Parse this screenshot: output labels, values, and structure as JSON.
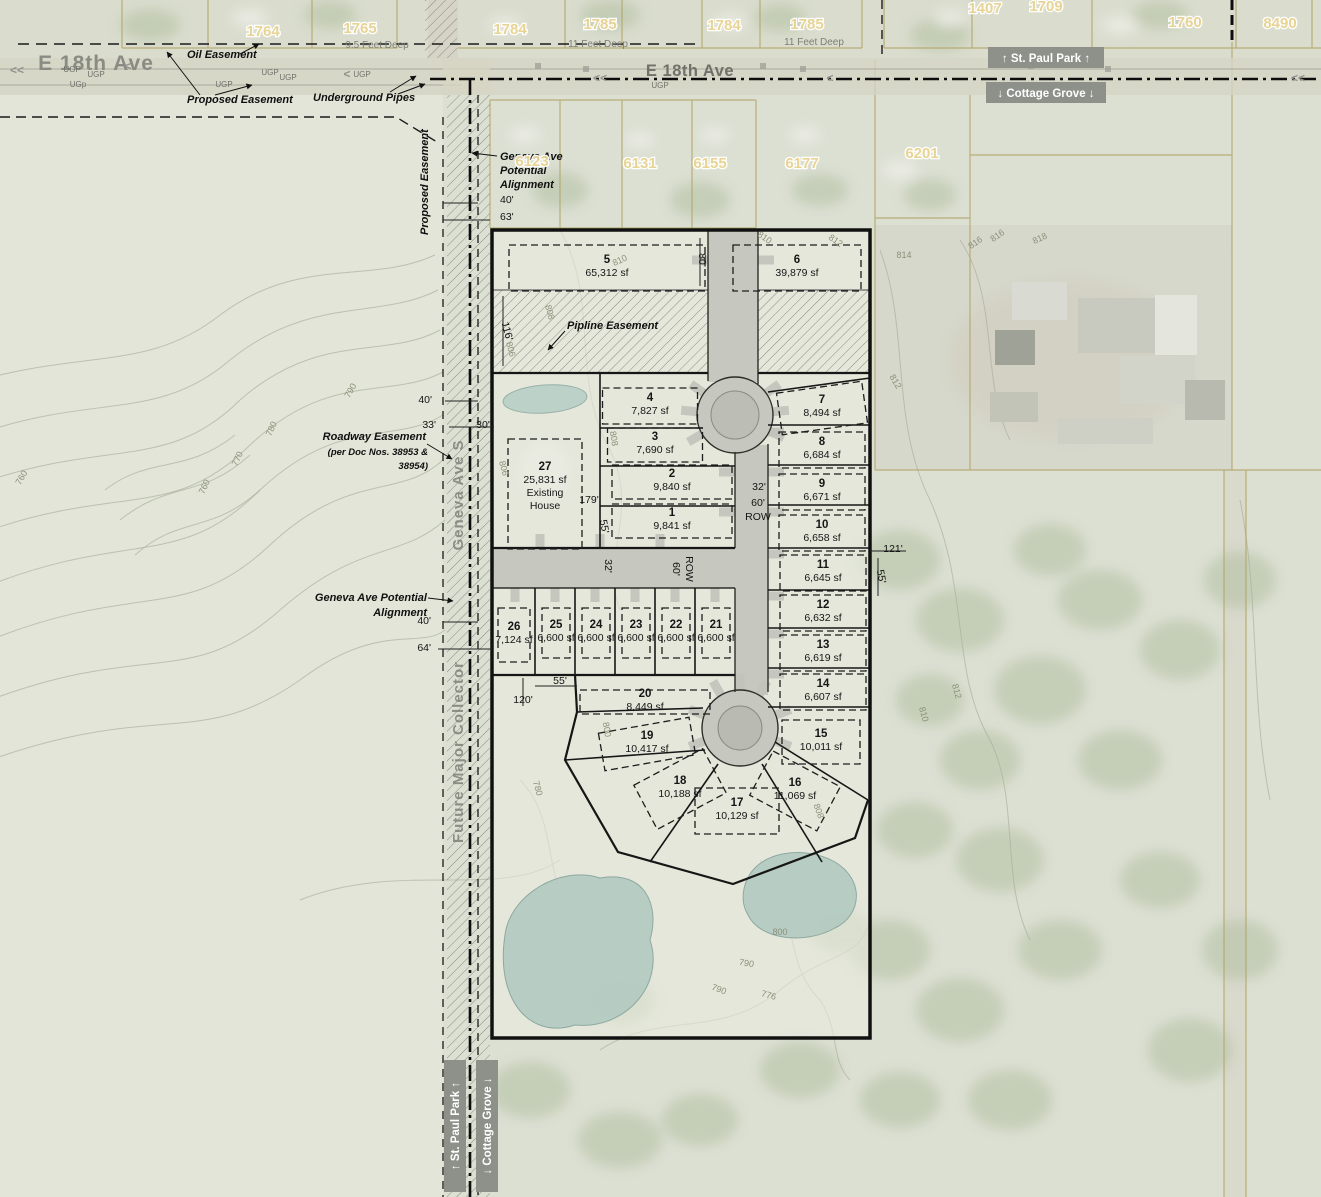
{
  "colors": {
    "boundary": "#111111",
    "road_gray": "#c6c7bf",
    "municipal_box": "#8e908a",
    "pond": "#b2cac1",
    "contour_line": "#a8ae9a",
    "parcel_line": "#b3a468",
    "house_number": "#e8d391",
    "label_gray": "#7c7e76"
  },
  "municipal": {
    "top_north": "↑ St. Paul Park ↑",
    "top_south": "↓ Cottage Grove ↓",
    "bottom_west": "↑ St. Paul Park ↑",
    "bottom_east": "↓ Cottage Grove ↓"
  },
  "annotations": [
    {
      "t": "E 18th Ave",
      "x": 96,
      "y": 70,
      "cls": "street-big"
    },
    {
      "t": "E 18th Ave",
      "x": 690,
      "y": 76,
      "cls": "street-mid"
    },
    {
      "t": "Geneva Ave S",
      "x": 463,
      "y": 495,
      "cls": "street-vert",
      "rot": -90
    },
    {
      "t": "Future Major Collector",
      "x": 463,
      "y": 752,
      "cls": "street-vert",
      "rot": -90
    },
    {
      "t": "Oil Easement",
      "x": 187,
      "y": 58,
      "cls": "ann",
      "anchor": "start"
    },
    {
      "t": "Proposed Easement",
      "x": 187,
      "y": 103,
      "cls": "ann",
      "anchor": "start"
    },
    {
      "t": "Underground Pipes",
      "x": 313,
      "y": 101,
      "cls": "ann",
      "anchor": "start"
    },
    {
      "t": "Proposed Easement",
      "x": 428,
      "y": 235,
      "cls": "ann",
      "rot": -90,
      "anchor": "start"
    },
    {
      "t": "Geneva Ave",
      "x": 500,
      "y": 160,
      "cls": "ann",
      "anchor": "start"
    },
    {
      "t": "Potential",
      "x": 500,
      "y": 174,
      "cls": "ann",
      "anchor": "start"
    },
    {
      "t": "Alignment",
      "x": 500,
      "y": 188,
      "cls": "ann",
      "anchor": "start"
    },
    {
      "t": "Roadway Easement",
      "x": 426,
      "y": 440,
      "cls": "ann",
      "anchor": "end"
    },
    {
      "t": "(per Doc Nos. 38953 &",
      "x": 428,
      "y": 455,
      "cls": "annsm",
      "anchor": "end"
    },
    {
      "t": "38954)",
      "x": 428,
      "y": 469,
      "cls": "annsm",
      "anchor": "end"
    },
    {
      "t": "Geneva Ave Potential",
      "x": 427,
      "y": 601,
      "cls": "ann",
      "anchor": "end"
    },
    {
      "t": "Alignment",
      "x": 427,
      "y": 616,
      "cls": "ann",
      "anchor": "end"
    },
    {
      "t": "Pipline Easement",
      "x": 567,
      "y": 329,
      "cls": "ann",
      "anchor": "start"
    },
    {
      "t": "9.5 Feet Deep",
      "x": 377,
      "y": 48,
      "cls": "graylbl"
    },
    {
      "t": "11 Feet Deep",
      "x": 598,
      "y": 47,
      "cls": "graylbl"
    },
    {
      "t": "11 Feet Deep",
      "x": 814,
      "y": 45,
      "cls": "graylbl"
    },
    {
      "t": "<<",
      "x": 10,
      "y": 74,
      "cls": "chev",
      "anchor": "start"
    },
    {
      "t": "<",
      "x": 128,
      "y": 70,
      "cls": "chev"
    },
    {
      "t": "<",
      "x": 347,
      "y": 78,
      "cls": "chev"
    },
    {
      "t": "<<",
      "x": 600,
      "y": 82,
      "cls": "chev"
    },
    {
      "t": "<",
      "x": 830,
      "y": 82,
      "cls": "chev"
    },
    {
      "t": "<<",
      "x": 1298,
      "y": 82,
      "cls": "chev"
    },
    {
      "t": "UGP",
      "x": 72,
      "y": 72,
      "cls": "ugp"
    },
    {
      "t": "UGP",
      "x": 96,
      "y": 77,
      "cls": "ugp"
    },
    {
      "t": "UGP",
      "x": 270,
      "y": 75,
      "cls": "ugp"
    },
    {
      "t": "UGP",
      "x": 288,
      "y": 80,
      "cls": "ugp"
    },
    {
      "t": "UGP",
      "x": 362,
      "y": 77,
      "cls": "ugp"
    },
    {
      "t": "UGp",
      "x": 78,
      "y": 87,
      "cls": "ugp"
    },
    {
      "t": "UGP",
      "x": 224,
      "y": 87,
      "cls": "ugp"
    },
    {
      "t": "UGP",
      "x": 660,
      "y": 88,
      "cls": "ugp"
    }
  ],
  "dimensions": [
    {
      "t": "40'",
      "x": 500,
      "y": 203,
      "anchor": "start"
    },
    {
      "t": "63'",
      "x": 500,
      "y": 220,
      "anchor": "start"
    },
    {
      "t": "40'",
      "x": 432,
      "y": 403,
      "anchor": "end"
    },
    {
      "t": "33'",
      "x": 436,
      "y": 428,
      "anchor": "end"
    },
    {
      "t": "30'",
      "x": 483,
      "y": 428
    },
    {
      "t": "116'",
      "x": 504,
      "y": 332,
      "rot": 75
    },
    {
      "t": "80'",
      "x": 699,
      "y": 260,
      "rot": 90
    },
    {
      "t": "179'",
      "x": 589,
      "y": 503
    },
    {
      "t": "55'",
      "x": 601,
      "y": 527,
      "rot": 80
    },
    {
      "t": "32'",
      "x": 759,
      "y": 490
    },
    {
      "t": "60'",
      "x": 758,
      "y": 506
    },
    {
      "t": "ROW",
      "x": 758,
      "y": 520
    },
    {
      "t": "121'",
      "x": 893,
      "y": 552
    },
    {
      "t": "55'",
      "x": 878,
      "y": 577,
      "rot": 80
    },
    {
      "t": "32'",
      "x": 605,
      "y": 566,
      "rot": 90
    },
    {
      "t": "60'",
      "x": 673,
      "y": 569,
      "rot": 90
    },
    {
      "t": "ROW",
      "x": 686,
      "y": 569,
      "rot": 90
    },
    {
      "t": "55'",
      "x": 560,
      "y": 684
    },
    {
      "t": "120'",
      "x": 523,
      "y": 703
    },
    {
      "t": "40'",
      "x": 431,
      "y": 624,
      "anchor": "end"
    },
    {
      "t": "64'",
      "x": 431,
      "y": 651,
      "anchor": "end"
    }
  ],
  "contour_labels": [
    {
      "t": "810",
      "x": 621,
      "y": 263,
      "rot": -25
    },
    {
      "t": "810",
      "x": 763,
      "y": 240,
      "rot": 35
    },
    {
      "t": "812",
      "x": 834,
      "y": 243,
      "rot": 35
    },
    {
      "t": "814",
      "x": 904,
      "y": 258
    },
    {
      "t": "816",
      "x": 977,
      "y": 245,
      "rot": -35
    },
    {
      "t": "816",
      "x": 999,
      "y": 238,
      "rot": -35
    },
    {
      "t": "818",
      "x": 1041,
      "y": 241,
      "rot": -25
    },
    {
      "t": "808",
      "x": 547,
      "y": 313,
      "rot": 75
    },
    {
      "t": "806",
      "x": 508,
      "y": 350,
      "rot": 75
    },
    {
      "t": "808",
      "x": 611,
      "y": 439,
      "rot": 80
    },
    {
      "t": "806",
      "x": 501,
      "y": 469,
      "rot": 75
    },
    {
      "t": "812",
      "x": 893,
      "y": 383,
      "rot": 60
    },
    {
      "t": "810",
      "x": 921,
      "y": 715,
      "rot": 75
    },
    {
      "t": "812",
      "x": 954,
      "y": 692,
      "rot": 75
    },
    {
      "t": "808",
      "x": 816,
      "y": 812,
      "rot": 70
    },
    {
      "t": "800",
      "x": 604,
      "y": 730,
      "rot": 80
    },
    {
      "t": "780",
      "x": 535,
      "y": 789,
      "rot": 75
    },
    {
      "t": "800",
      "x": 780,
      "y": 935
    },
    {
      "t": "790",
      "x": 746,
      "y": 966,
      "rot": 10
    },
    {
      "t": "776",
      "x": 768,
      "y": 998,
      "rot": 15
    },
    {
      "t": "790",
      "x": 718,
      "y": 992,
      "rot": 20
    },
    {
      "t": "790",
      "x": 353,
      "y": 392,
      "rot": -60
    },
    {
      "t": "780",
      "x": 274,
      "y": 430,
      "rot": -65
    },
    {
      "t": "770",
      "x": 240,
      "y": 460,
      "rot": -65
    },
    {
      "t": "760",
      "x": 207,
      "y": 488,
      "rot": -65
    },
    {
      "t": "760",
      "x": 24,
      "y": 479,
      "rot": -60
    }
  ],
  "house_numbers": [
    {
      "t": "1764",
      "x": 263,
      "y": 36
    },
    {
      "t": "1765",
      "x": 360,
      "y": 33
    },
    {
      "t": "1784",
      "x": 510,
      "y": 34
    },
    {
      "t": "1785",
      "x": 600,
      "y": 29
    },
    {
      "t": "1784",
      "x": 724,
      "y": 30
    },
    {
      "t": "1785",
      "x": 807,
      "y": 29
    },
    {
      "t": "1407",
      "x": 985,
      "y": 13
    },
    {
      "t": "1709",
      "x": 1046,
      "y": 11
    },
    {
      "t": "1760",
      "x": 1185,
      "y": 27
    },
    {
      "t": "8490",
      "x": 1280,
      "y": 28
    },
    {
      "t": "6123",
      "x": 532,
      "y": 166
    },
    {
      "t": "6131",
      "x": 640,
      "y": 168
    },
    {
      "t": "6155",
      "x": 710,
      "y": 168
    },
    {
      "t": "6177",
      "x": 802,
      "y": 168
    },
    {
      "t": "6201",
      "x": 922,
      "y": 158
    }
  ],
  "lots": [
    {
      "n": "1",
      "sf": "9,841 sf",
      "x": 672,
      "y": 519,
      "bw": 120,
      "bh": 34
    },
    {
      "n": "2",
      "sf": "9,840 sf",
      "x": 672,
      "y": 480,
      "bw": 120,
      "bh": 34
    },
    {
      "n": "3",
      "sf": "7,690 sf",
      "x": 655,
      "y": 443,
      "bw": 95,
      "bh": 34
    },
    {
      "n": "4",
      "sf": "7,827 sf",
      "x": 650,
      "y": 404,
      "bw": 95,
      "bh": 36
    },
    {
      "n": "5",
      "sf": "65,312 sf",
      "x": 607,
      "y": 266,
      "bw": 196,
      "bh": 46
    },
    {
      "n": "6",
      "sf": "39,879 sf",
      "x": 797,
      "y": 266,
      "bw": 128,
      "bh": 46
    },
    {
      "n": "7",
      "sf": "8,494 sf",
      "x": 822,
      "y": 406,
      "bw": 86,
      "bh": 42,
      "rot": -8
    },
    {
      "n": "8",
      "sf": "6,684 sf",
      "x": 822,
      "y": 448,
      "bw": 86,
      "bh": 36
    },
    {
      "n": "9",
      "sf": "6,671 sf",
      "x": 822,
      "y": 490,
      "bw": 86,
      "bh": 36
    },
    {
      "n": "10",
      "sf": "6,658 sf",
      "x": 822,
      "y": 531,
      "bw": 86,
      "bh": 36
    },
    {
      "n": "11",
      "sf": "6,645 sf",
      "x": 823,
      "y": 571,
      "bw": 86,
      "bh": 36
    },
    {
      "n": "12",
      "sf": "6,632 sf",
      "x": 823,
      "y": 611,
      "bw": 86,
      "bh": 36
    },
    {
      "n": "13",
      "sf": "6,619 sf",
      "x": 823,
      "y": 651,
      "bw": 86,
      "bh": 36
    },
    {
      "n": "14",
      "sf": "6,607 sf",
      "x": 823,
      "y": 690,
      "bw": 86,
      "bh": 36
    },
    {
      "n": "15",
      "sf": "10,011 sf",
      "x": 821,
      "y": 740,
      "bw": 78,
      "bh": 44
    },
    {
      "n": "16",
      "sf": "11,069 sf",
      "x": 795,
      "y": 789,
      "bw": 76,
      "bh": 50,
      "rot": 28
    },
    {
      "n": "17",
      "sf": "10,129 sf",
      "x": 737,
      "y": 809,
      "bw": 84,
      "bh": 46
    },
    {
      "n": "18",
      "sf": "10,188 sf",
      "x": 680,
      "y": 787,
      "bw": 78,
      "bh": 50,
      "rot": -28
    },
    {
      "n": "19",
      "sf": "10,417 sf",
      "x": 647,
      "y": 742,
      "bw": 92,
      "bh": 38,
      "rot": -10
    },
    {
      "n": "20",
      "sf": "8,449 sf",
      "x": 645,
      "y": 700,
      "bw": 130,
      "bh": 24
    },
    {
      "n": "21",
      "sf": "6,600 sf",
      "x": 716,
      "y": 631,
      "bw": 28,
      "bh": 50
    },
    {
      "n": "22",
      "sf": "6,600 sf",
      "x": 676,
      "y": 631,
      "bw": 28,
      "bh": 50
    },
    {
      "n": "23",
      "sf": "6,600 sf",
      "x": 636,
      "y": 631,
      "bw": 28,
      "bh": 50
    },
    {
      "n": "24",
      "sf": "6,600 sf",
      "x": 596,
      "y": 631,
      "bw": 28,
      "bh": 50
    },
    {
      "n": "25",
      "sf": "6,600 sf",
      "x": 556,
      "y": 631,
      "bw": 28,
      "bh": 50
    },
    {
      "n": "26",
      "sf": "7,124 sf",
      "x": 514,
      "y": 633,
      "bw": 32,
      "bh": 54
    },
    {
      "n": "27",
      "sf": "25,831 sf",
      "x": 545,
      "y": 492,
      "bw": 74,
      "bh": 110,
      "extra": [
        "Existing",
        "House"
      ]
    }
  ]
}
